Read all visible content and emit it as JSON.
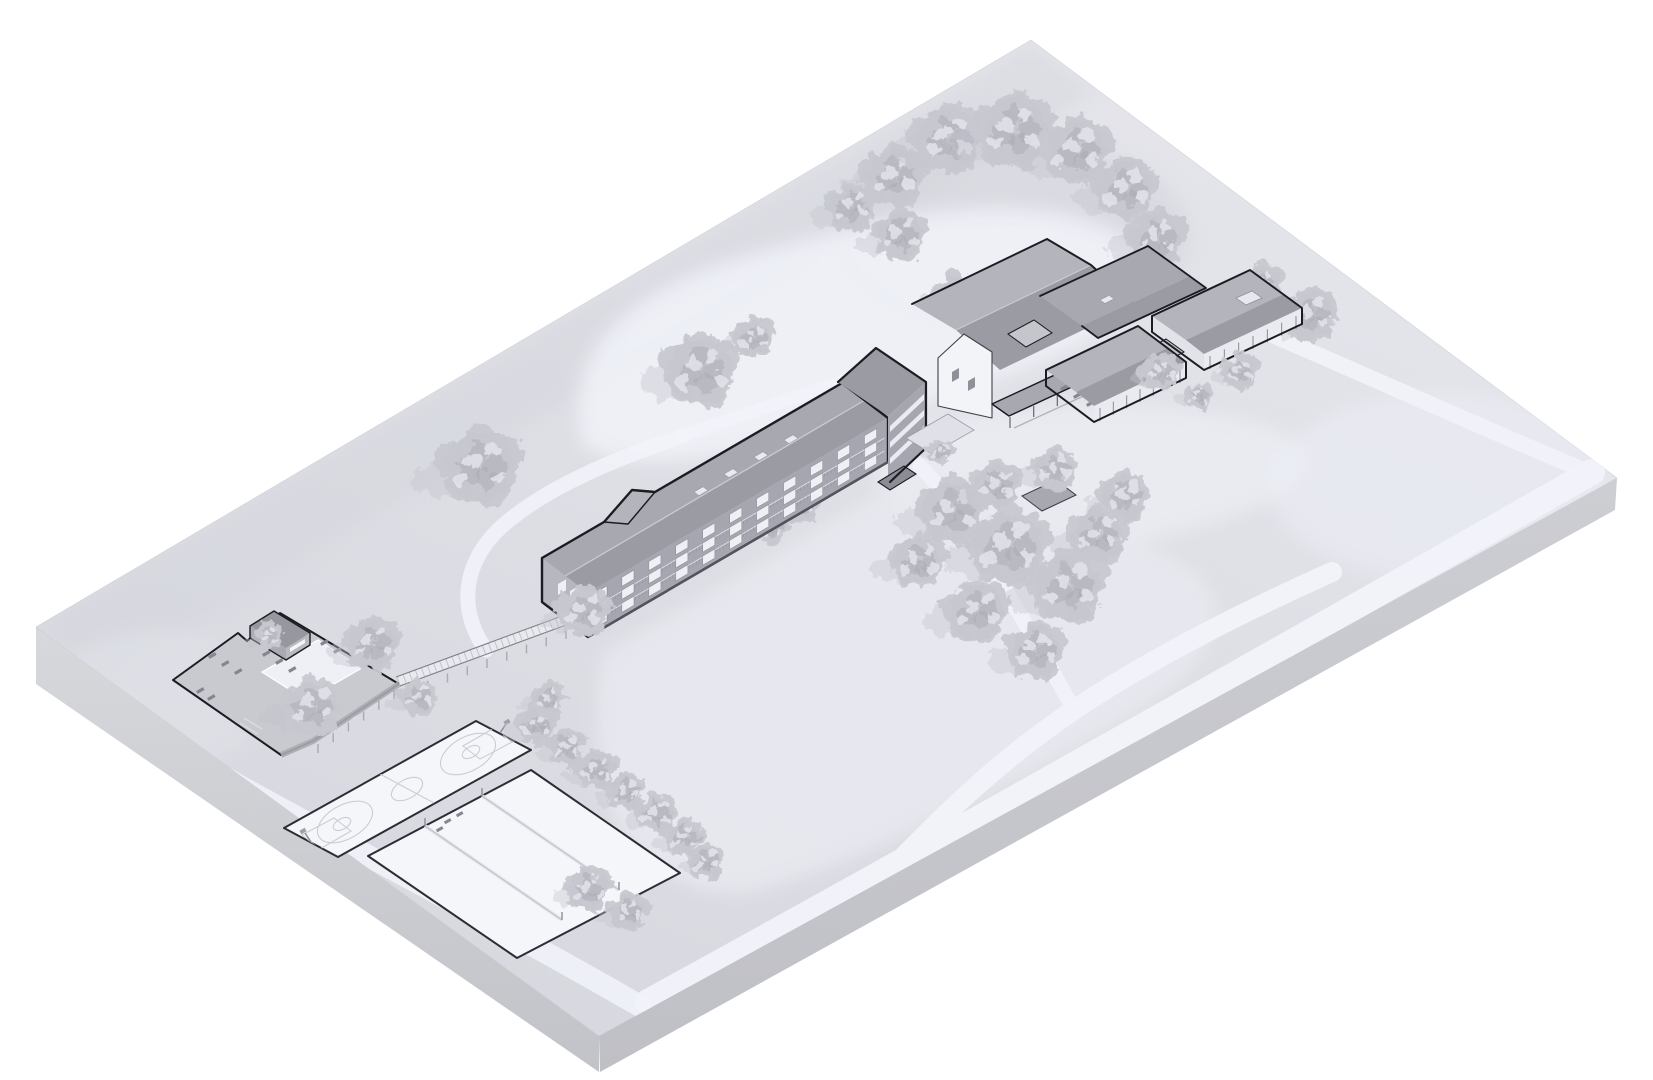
{
  "scene": {
    "title": "Axonometric architectural site plan rendering",
    "description": "Monochrome isometric site model on a floating ground slab: long three-story dormitory with boardwalk to a walled pool compound, gabled lodge complex with porch and cabins, basketball and volleyball courts, winding light paths and scattered trees."
  },
  "colors": {
    "bg": "#ffffff",
    "slabTop1": "#e4e5eb",
    "slabTop2": "#d8d9e0",
    "slabLeft1": "#d7d8dc",
    "slabLeft2": "#c2c3c8",
    "slabRight1": "#cdced3",
    "slabRight2": "#bfc0c6",
    "clearing": "#eef0f7",
    "lawn": "#e8e9f0",
    "patch": "#d3d4db",
    "road": "#f2f3fa",
    "tree": "#c7c8d0",
    "treeDark": "#a9aab4",
    "treeLight": "#e3e4eb",
    "treeShadow": "#c3c4cc",
    "outline": "#1b1c23",
    "roofLight": "#b3b4bc",
    "roofDark": "#9a9ba3",
    "roofMid": "#a7a8b0",
    "ridge": "#cbccd2",
    "wall": "#a5a6af",
    "wallLight": "#eaebf0",
    "gable": "#f3f4f7",
    "win": "#eff0f5",
    "winFrame": "#7d7e88",
    "court": "#f5f6fa",
    "courtLine": "#cbccd5",
    "courtOutline": "#2b2c34",
    "deck": "#c9cacf",
    "deckDark": "#aaabb3",
    "pool": "#eef0f6",
    "board": "#e9eaef",
    "rail": "#7e7f88",
    "post": "#a9aab2",
    "shadow": "#8e8f98",
    "canopy": "#8b8c94"
  },
  "roads": [
    [
      "M 648,1002 C 900,864 1280,650 1592,472",
      26,
      0.95
    ],
    [
      "M 640,1006 C 470,908 300,822 166,744",
      22,
      0.85
    ],
    [
      "M 856,908 C 940,814 1008,754 1074,710 C 1148,660 1238,614 1332,572",
      20,
      0.95
    ],
    [
      "M 1074,710 C 1042,652 1002,582 966,526 C 950,502 938,484 920,466",
      15,
      0.9
    ],
    [
      "M 486,650 C 456,608 462,556 512,518 C 552,486 612,460 682,436",
      15,
      0.9
    ],
    [
      "M 682,436 C 762,408 830,386 894,364",
      13,
      0.85
    ],
    [
      "M 1132,276 C 1272,332 1430,406 1588,472",
      16,
      0.9
    ],
    [
      "M 352,714 C 300,692 256,682 204,670",
      10,
      0.7
    ]
  ],
  "trees_back": [
    [
      893,
      178,
      1.15
    ],
    [
      948,
      140,
      1.3
    ],
    [
      1013,
      132,
      1.4
    ],
    [
      1076,
      152,
      1.25
    ],
    [
      1125,
      190,
      1.15
    ],
    [
      1156,
      240,
      1.05
    ],
    [
      1120,
      292,
      1.0
    ],
    [
      900,
      236,
      0.95
    ],
    [
      851,
      208,
      0.9
    ],
    [
      955,
      296,
      0.8
    ],
    [
      1040,
      318,
      0.85
    ],
    [
      1262,
      286,
      0.8
    ],
    [
      1310,
      316,
      1.0
    ],
    [
      700,
      372,
      1.35
    ],
    [
      753,
      338,
      0.75
    ],
    [
      480,
      468,
      1.45
    ],
    [
      312,
      708,
      1.1
    ],
    [
      372,
      645,
      1.0
    ],
    [
      418,
      698,
      0.65
    ],
    [
      268,
      636,
      0.5
    ],
    [
      536,
      726,
      0.72
    ],
    [
      566,
      748,
      0.68
    ],
    [
      596,
      770,
      0.72
    ],
    [
      626,
      792,
      0.68
    ],
    [
      656,
      814,
      0.72
    ],
    [
      684,
      838,
      0.68
    ],
    [
      706,
      862,
      0.62
    ],
    [
      588,
      890,
      0.82
    ],
    [
      628,
      912,
      0.68
    ],
    [
      548,
      700,
      0.6
    ],
    [
      772,
      530,
      0.55
    ],
    [
      800,
      505,
      0.7
    ]
  ],
  "trees_front": [
    [
      583,
      612,
      0.95
    ],
    [
      952,
      512,
      1.25
    ],
    [
      1008,
      548,
      1.45
    ],
    [
      1068,
      588,
      1.35
    ],
    [
      976,
      612,
      1.15
    ],
    [
      1036,
      652,
      1.05
    ],
    [
      918,
      562,
      1.0
    ],
    [
      1098,
      536,
      1.05
    ],
    [
      1124,
      498,
      0.9
    ],
    [
      1054,
      470,
      0.8
    ],
    [
      996,
      486,
      0.9
    ],
    [
      940,
      452,
      0.45
    ],
    [
      1240,
      372,
      0.65
    ],
    [
      1198,
      396,
      0.5
    ],
    [
      1160,
      372,
      0.7
    ]
  ],
  "dorm_windows": {
    "x0": 8,
    "dx": 31.2,
    "cols": 11,
    "rows": [
      -40,
      -27,
      -14
    ],
    "w": 14,
    "h": 9
  }
}
